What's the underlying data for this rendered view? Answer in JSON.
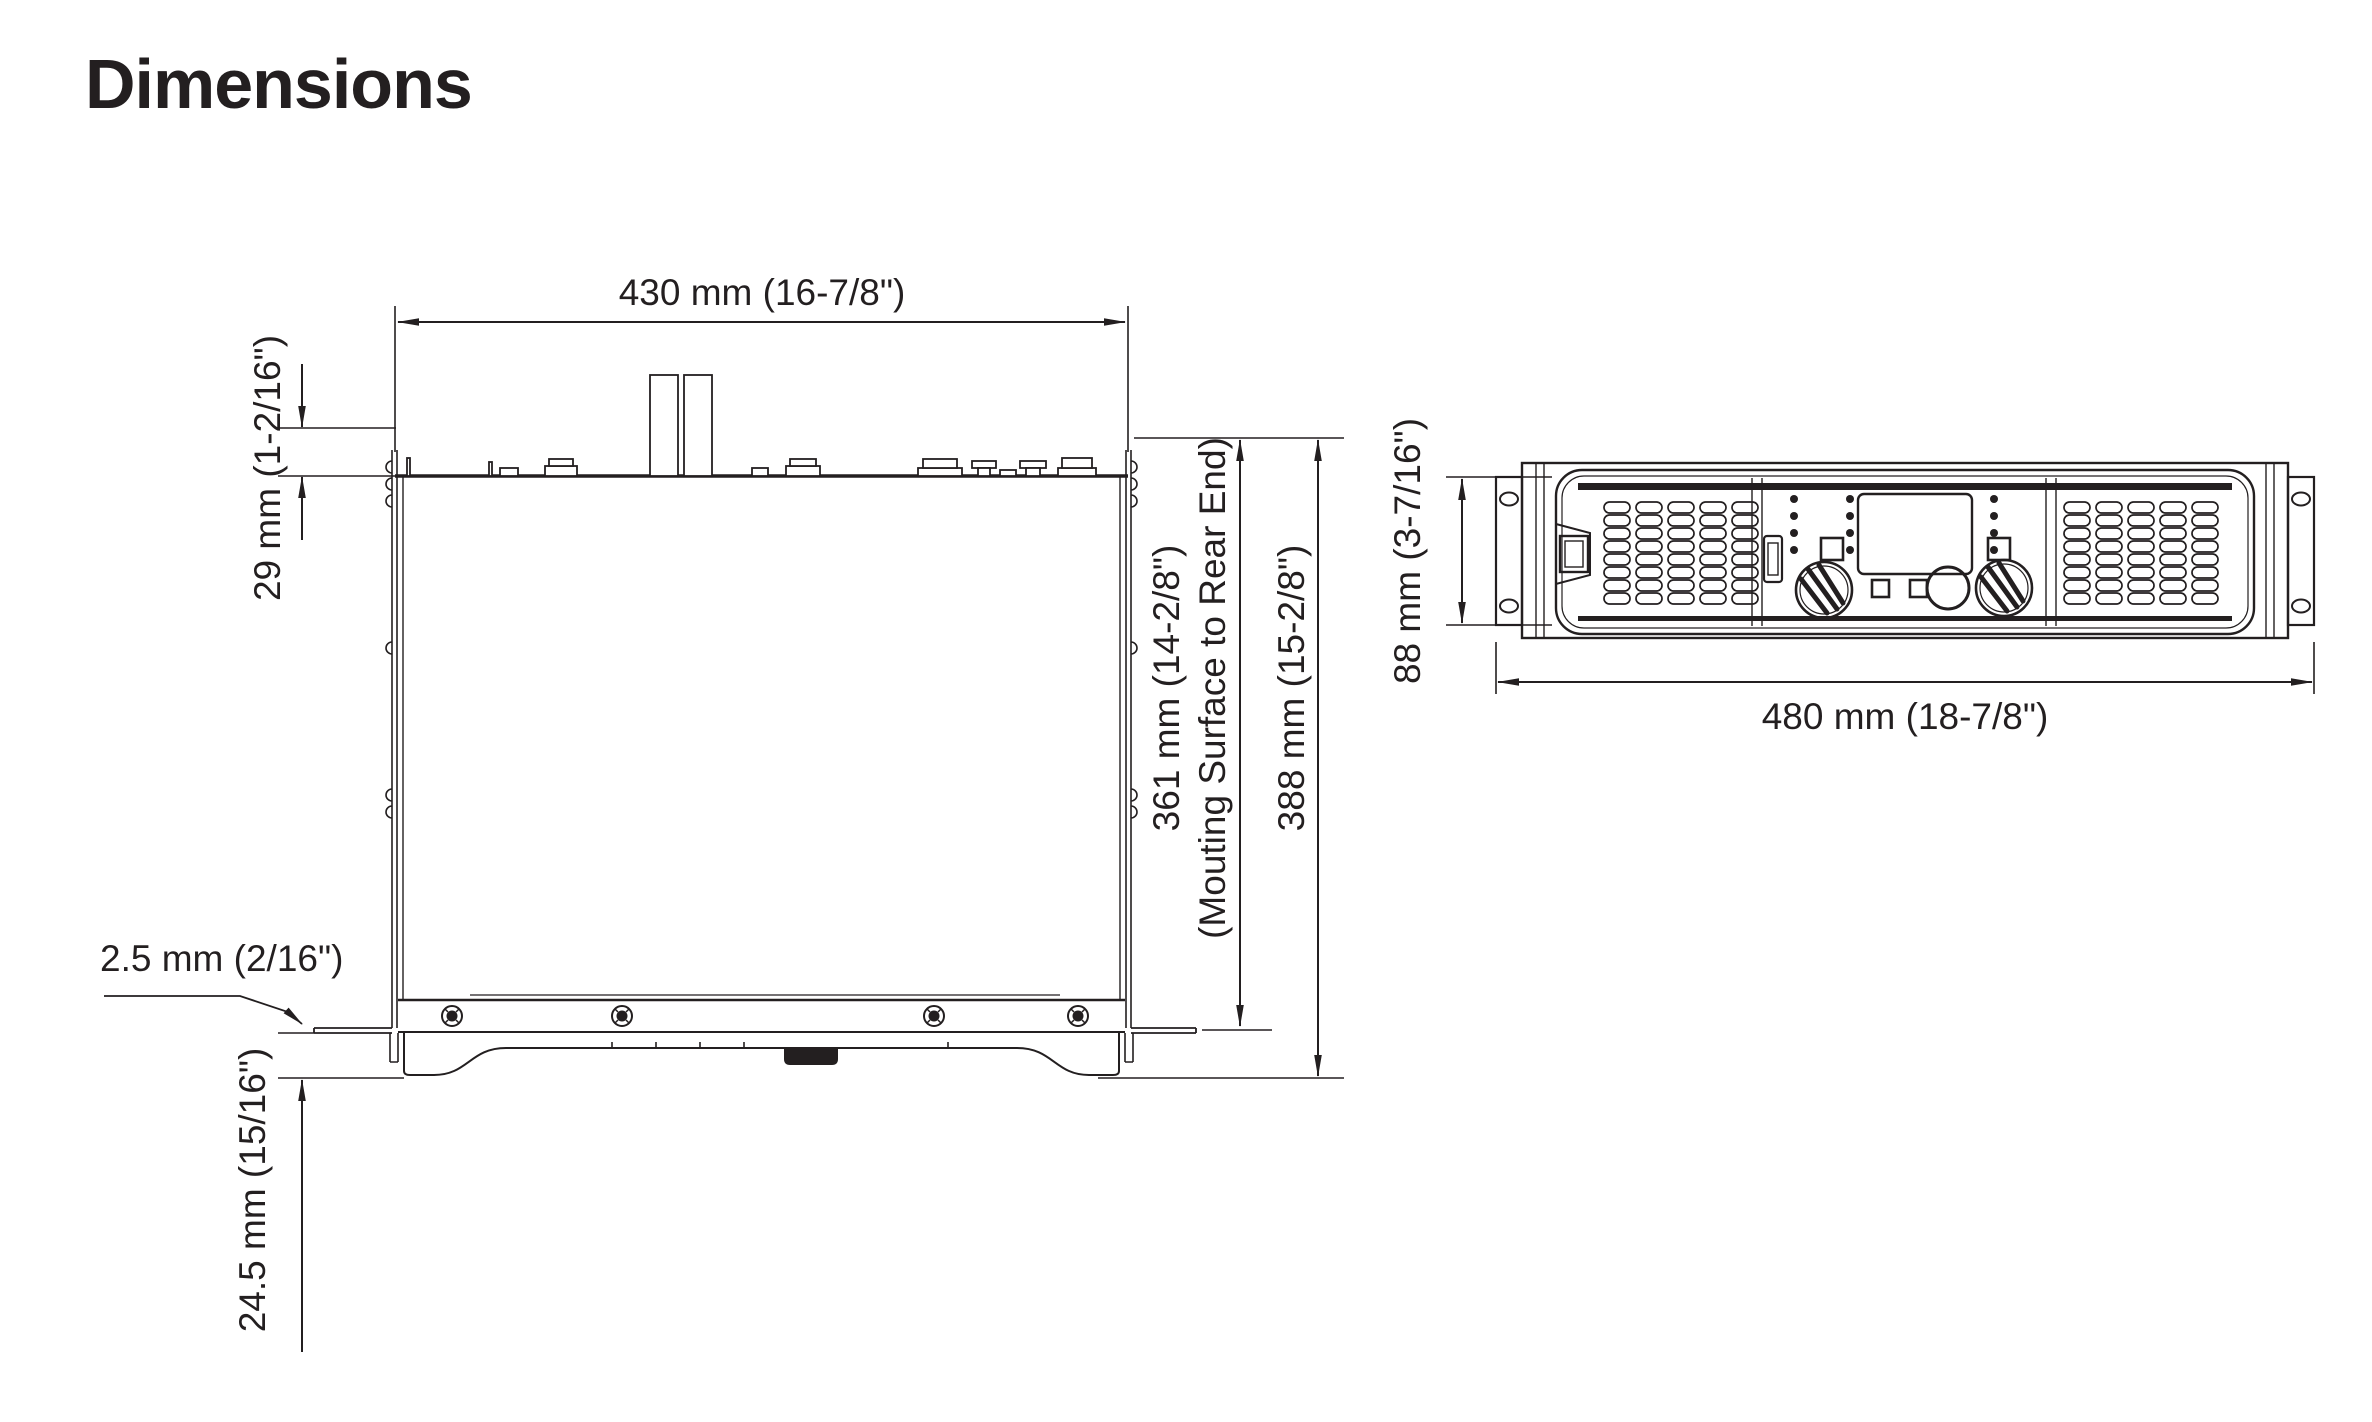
{
  "title": "Dimensions",
  "ink_color": "#231f20",
  "top_view": {
    "name": "top-view-drawing",
    "width_label": "430 mm (16-7/8\")",
    "rear_offset_label": "29 mm (1-2/16\")",
    "mounting_depth_label": "361 mm (14-2/8\")",
    "mounting_depth_note": "(Mouting Surface to Rear End)",
    "total_depth_label": "388 mm (15-2/8\")",
    "bracket_thickness_label": "2.5 mm (2/16\")",
    "front_protrusion_label": "24.5 mm (15/16\")"
  },
  "front_view": {
    "name": "front-view-drawing",
    "height_label": "88 mm (3-7/16\")",
    "width_label": "480 mm (18-7/8\")"
  }
}
